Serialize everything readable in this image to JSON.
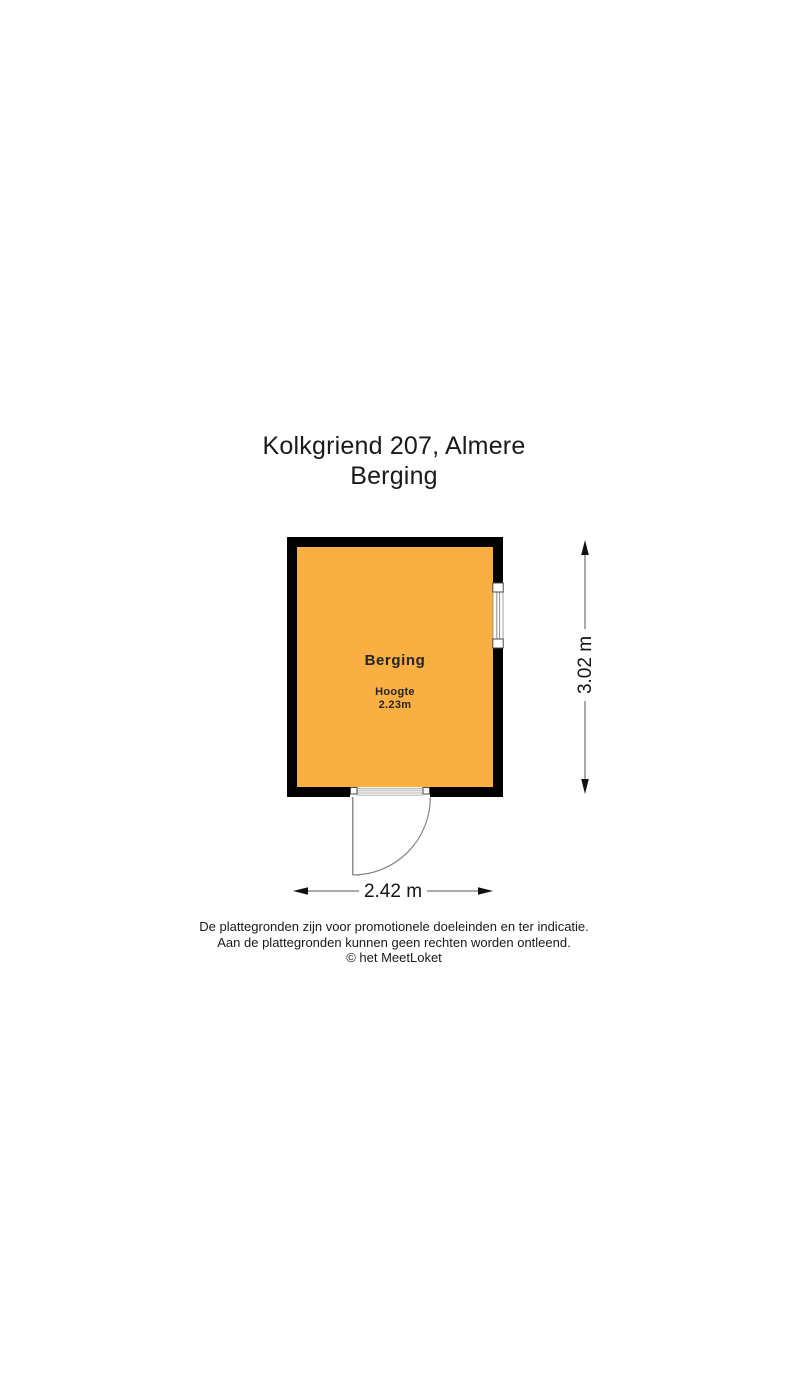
{
  "title": {
    "address": "Kolkgriend 207, Almere",
    "subtitle": "Berging"
  },
  "room": {
    "name": "Berging",
    "height_label": "Hoogte",
    "height_value": "2.23m"
  },
  "dimensions": {
    "width": "2.42 m",
    "height": "3.02 m"
  },
  "disclaimer": {
    "line1": "De plattegronden zijn voor promotionele doeleinden en ter indicatie.",
    "line2": "Aan de plattegronden kunnen geen rechten worden ontleend.",
    "line3": "© het MeetLoket"
  },
  "colors": {
    "room_fill": "#FAAF42",
    "wall": "#000000"
  }
}
